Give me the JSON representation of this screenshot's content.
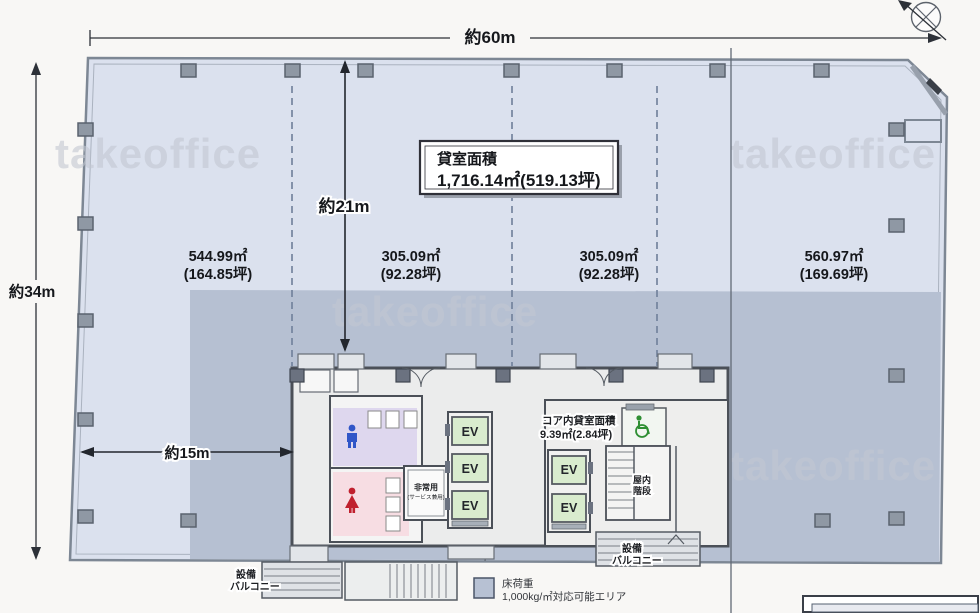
{
  "watermark": "takeoffice",
  "dimensions": {
    "width_total": "約60m",
    "height_total": "約34m",
    "core_offset": "約21m",
    "west_span": "約15m"
  },
  "rent_area": {
    "label": "貸室面積",
    "value": "1,716.14㎡(519.13坪)"
  },
  "zones": [
    {
      "m2": "544.99㎡",
      "tsubo": "(164.85坪)"
    },
    {
      "m2": "305.09㎡",
      "tsubo": "(92.28坪)"
    },
    {
      "m2": "305.09㎡",
      "tsubo": "(92.28坪)"
    },
    {
      "m2": "560.97㎡",
      "tsubo": "(169.69坪)"
    }
  ],
  "core": {
    "inner_rent_label": "コア内貸室面積",
    "inner_rent_value": "9.39㎡(2.84坪)",
    "ev_label": "EV",
    "emergency_ev_line1": "非常用",
    "emergency_ev_line2": "(サービス兼用)",
    "stair_line1": "屋内",
    "stair_line2": "階段"
  },
  "balconies": {
    "left_line1": "設備",
    "left_line2": "バルコニー",
    "right_line1": "設備",
    "right_line2": "バルコニー"
  },
  "legend": {
    "title": "床荷重",
    "description": "1,000kg/㎡対応可能エリア",
    "swatch_color": "#b7c1d3"
  },
  "colors": {
    "floor_light": "#dbe1ee",
    "floor_load_area": "#b6c0d2",
    "ev_fill": "#d9ecce",
    "outline": "#7d8794"
  }
}
